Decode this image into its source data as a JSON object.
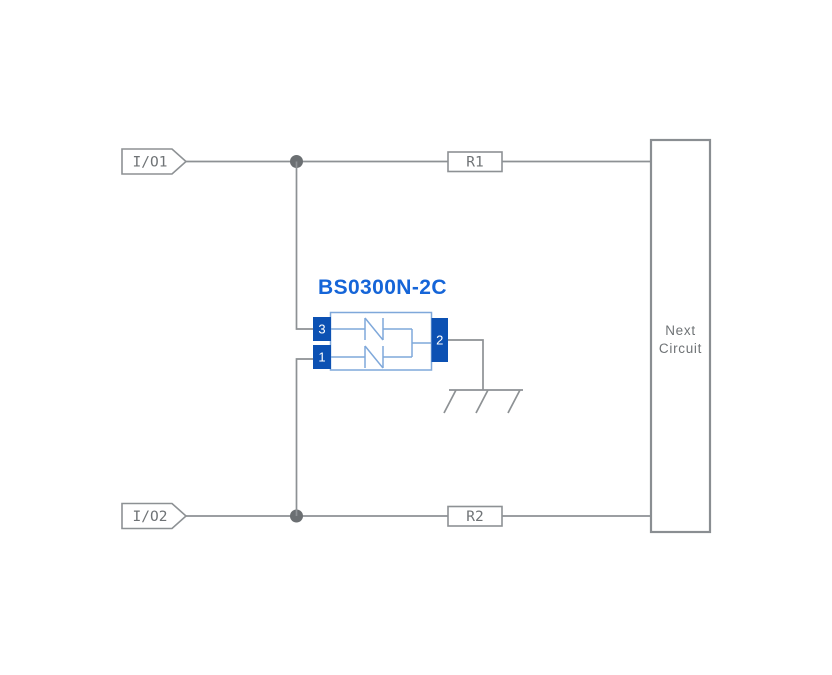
{
  "diagram": {
    "io_tags": [
      {
        "label": "I/O1"
      },
      {
        "label": "I/O2"
      }
    ],
    "resistors": [
      {
        "label": "R1"
      },
      {
        "label": "R2"
      }
    ],
    "component": {
      "name": "BS0300N-2C",
      "pins": [
        {
          "number": "3"
        },
        {
          "number": "1"
        },
        {
          "number": "2"
        }
      ]
    },
    "next_circuit": {
      "line1": "Next",
      "line2": "Circuit"
    }
  },
  "colors": {
    "wire": "#8d9194",
    "wire-strong": "#8a8e92",
    "dot": "#6b6f72",
    "text-gray": "#6f7376",
    "blue-dark": "#0c51b3",
    "blue-light": "#7fa8da",
    "blue-title": "#1565d8"
  }
}
